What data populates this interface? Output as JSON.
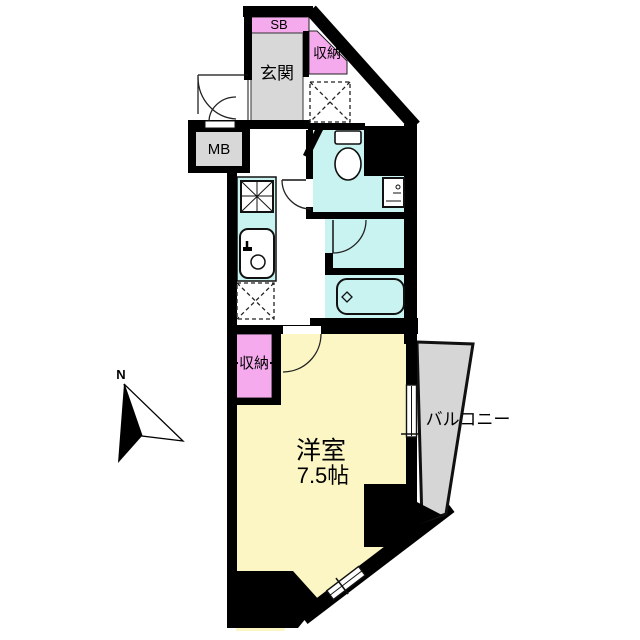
{
  "floorplan": {
    "labels": {
      "sb": "SB",
      "entrance": "玄関",
      "storage_upper": "収納",
      "meter_box": "MB",
      "storage_lower": "収納",
      "room_name": "洋室",
      "room_size": "7.5帖",
      "balcony": "バルコニー",
      "north": "N"
    },
    "rooms": [
      {
        "id": "entrance-hall",
        "label": "玄関",
        "type": "entry"
      },
      {
        "id": "shoe-box",
        "label": "SB",
        "type": "storage"
      },
      {
        "id": "upper-storage",
        "label": "収納",
        "type": "storage"
      },
      {
        "id": "meter-box",
        "label": "MB",
        "type": "utility"
      },
      {
        "id": "lower-storage",
        "label": "収納",
        "type": "storage"
      },
      {
        "id": "western-room",
        "label": "洋室",
        "size": "7.5帖",
        "type": "bedroom"
      },
      {
        "id": "balcony",
        "label": "バルコニー",
        "type": "outdoor"
      }
    ],
    "fixture_icons": [
      "toilet-icon",
      "washbasin-icon",
      "bathtub-icon",
      "kitchen-sink-icon",
      "gas-stove-icon",
      "door-swing-arc",
      "window-glyph",
      "closet-cross-box",
      "compass-north-arrow"
    ],
    "colors": {
      "wall": "#000000",
      "main_room": "#fbf6c3",
      "wet_area": "#c9f3f1",
      "closet_pink": "#f6aaee",
      "entry_gray": "#d8d8d8",
      "balcony_gray": "#d6d6d6",
      "background": "#ffffff"
    }
  }
}
